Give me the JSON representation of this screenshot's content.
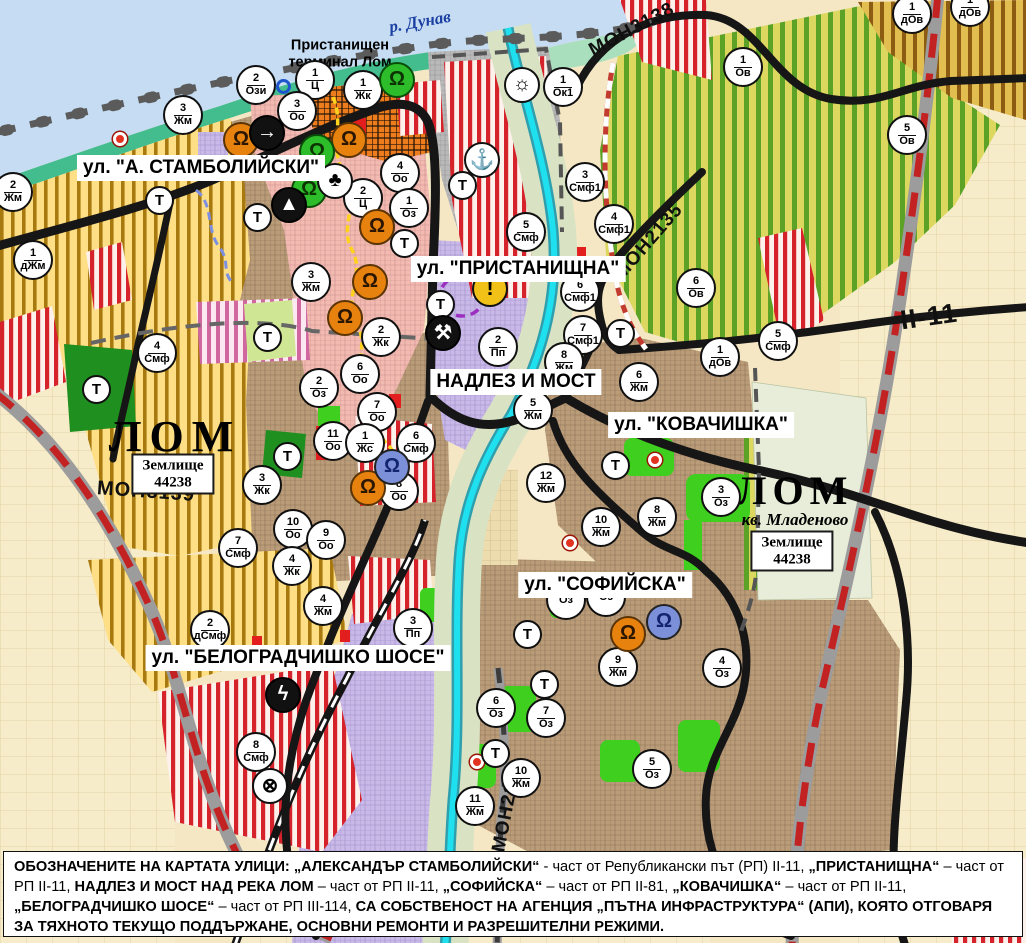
{
  "map": {
    "water_label": "р. Дунав",
    "port_terminal_label": "Пристанищен\nтерминал Лом",
    "t_label": "Т",
    "street_labels": [
      {
        "text": "ул. \"А. СТАМБОЛИЙСКИ\"",
        "x": 201,
        "y": 168
      },
      {
        "text": "ул. \"ПРИСТАНИЩНА\"",
        "x": 518,
        "y": 269
      },
      {
        "text": "НАДЛЕЗ И МОСТ",
        "x": 516,
        "y": 382
      },
      {
        "text": "ул. \"КОВАЧИШКА\"",
        "x": 701,
        "y": 425
      },
      {
        "text": "ул. \"СОФИЙСКА\"",
        "x": 605,
        "y": 585
      },
      {
        "text": "ул. \"БЕЛОГРАДЧИШКО ШОСЕ\"",
        "x": 298,
        "y": 658
      }
    ],
    "road_labels": [
      {
        "text": "МОН3138",
        "x": 632,
        "y": 30,
        "rot": -28,
        "size": 19
      },
      {
        "text": "МОН2135",
        "x": 649,
        "y": 242,
        "rot": -49,
        "size": 19
      },
      {
        "text": "МОН3139",
        "x": 146,
        "y": 492,
        "rot": 4,
        "size": 20
      },
      {
        "text": "МОН2136",
        "x": 508,
        "y": 806,
        "rot": -79,
        "size": 19
      },
      {
        "text": "II-11",
        "x": 929,
        "y": 317,
        "rot": -8,
        "size": 27
      }
    ],
    "place_labels": [
      {
        "text": "ЛОМ",
        "x": 175,
        "y": 437,
        "size": 44,
        "ls": 8,
        "sub": ""
      },
      {
        "text": "ЛОМ",
        "x": 795,
        "y": 500,
        "size": 40,
        "ls": 6,
        "sub": "кв. Младеново"
      }
    ],
    "land_boxes": [
      {
        "line1": "Землище",
        "line2": "44238",
        "x": 173,
        "y": 474
      },
      {
        "line1": "Землище",
        "line2": "44238",
        "x": 792,
        "y": 551
      }
    ],
    "zone_markers": [
      {
        "n": "2",
        "c": "Ози",
        "x": 256,
        "y": 85
      },
      {
        "n": "1",
        "c": "Ц",
        "x": 315,
        "y": 80
      },
      {
        "n": "1",
        "c": "Жк",
        "x": 363,
        "y": 90
      },
      {
        "n": "3",
        "c": "Оо",
        "x": 297,
        "y": 111
      },
      {
        "n": "3",
        "c": "Жм",
        "x": 183,
        "y": 115
      },
      {
        "n": "2",
        "c": "Жм",
        "x": 13,
        "y": 192
      },
      {
        "n": "1",
        "c": "дЖм",
        "x": 33,
        "y": 260
      },
      {
        "n": "4",
        "c": "Оо",
        "x": 400,
        "y": 173
      },
      {
        "n": "2",
        "c": "Ц",
        "x": 363,
        "y": 198
      },
      {
        "n": "1",
        "c": "Оз",
        "x": 409,
        "y": 208
      },
      {
        "n": "3",
        "c": "Жм",
        "x": 311,
        "y": 282
      },
      {
        "n": "2",
        "c": "Жк",
        "x": 381,
        "y": 337
      },
      {
        "n": "2",
        "c": "Оз",
        "x": 319,
        "y": 388
      },
      {
        "n": "6",
        "c": "Оо",
        "x": 360,
        "y": 374
      },
      {
        "n": "7",
        "c": "Оо",
        "x": 377,
        "y": 412
      },
      {
        "n": "11",
        "c": "Оо",
        "x": 333,
        "y": 441
      },
      {
        "n": "1",
        "c": "Жс",
        "x": 365,
        "y": 443
      },
      {
        "n": "6",
        "c": "Смф",
        "x": 416,
        "y": 443
      },
      {
        "n": "8",
        "c": "Оо",
        "x": 399,
        "y": 491
      },
      {
        "n": "10",
        "c": "Оо",
        "x": 293,
        "y": 529
      },
      {
        "n": "9",
        "c": "Оо",
        "x": 326,
        "y": 540
      },
      {
        "n": "7",
        "c": "Смф",
        "x": 238,
        "y": 548
      },
      {
        "n": "4",
        "c": "Жк",
        "x": 292,
        "y": 566
      },
      {
        "n": "3",
        "c": "Жк",
        "x": 262,
        "y": 485
      },
      {
        "n": "4",
        "c": "Смф",
        "x": 157,
        "y": 353
      },
      {
        "n": "4",
        "c": "Жм",
        "x": 323,
        "y": 606
      },
      {
        "n": "2",
        "c": "дСмф",
        "x": 210,
        "y": 630
      },
      {
        "n": "3",
        "c": "Пп",
        "x": 413,
        "y": 628
      },
      {
        "n": "8",
        "c": "Смф",
        "x": 256,
        "y": 752
      },
      {
        "n": "3",
        "c": "Смф1",
        "x": 585,
        "y": 182
      },
      {
        "n": "4",
        "c": "Смф1",
        "x": 614,
        "y": 224
      },
      {
        "n": "5",
        "c": "Смф",
        "x": 526,
        "y": 232
      },
      {
        "n": "1",
        "c": "Ок1",
        "x": 563,
        "y": 87
      },
      {
        "n": "6",
        "c": "Смф1",
        "x": 580,
        "y": 292
      },
      {
        "n": "7",
        "c": "Смф1",
        "x": 583,
        "y": 335
      },
      {
        "n": "2",
        "c": "Пп",
        "x": 498,
        "y": 347
      },
      {
        "n": "5",
        "c": "Жм",
        "x": 533,
        "y": 410
      },
      {
        "n": "8",
        "c": "Жм",
        "x": 564,
        "y": 362
      },
      {
        "n": "6",
        "c": "Жм",
        "x": 639,
        "y": 382
      },
      {
        "n": "12",
        "c": "Жм",
        "x": 546,
        "y": 483
      },
      {
        "n": "10",
        "c": "Жм",
        "x": 601,
        "y": 527
      },
      {
        "n": "8",
        "c": "Жм",
        "x": 657,
        "y": 517
      },
      {
        "n": "3",
        "c": "Оз",
        "x": 721,
        "y": 497
      },
      {
        "n": "1",
        "c": "Ов",
        "x": 743,
        "y": 67
      },
      {
        "n": "5",
        "c": "Ов",
        "x": 907,
        "y": 135
      },
      {
        "n": "1",
        "c": "дОв",
        "x": 912,
        "y": 14
      },
      {
        "n": "1",
        "c": "дОв",
        "x": 970,
        "y": 7
      },
      {
        "n": "6",
        "c": "Ов",
        "x": 696,
        "y": 288
      },
      {
        "n": "1",
        "c": "дОв",
        "x": 720,
        "y": 357
      },
      {
        "n": "5",
        "c": "Смф",
        "x": 778,
        "y": 341
      },
      {
        "n": "",
        "c": "Оз",
        "x": 566,
        "y": 600
      },
      {
        "n": "",
        "c": "Оз",
        "x": 606,
        "y": 597
      },
      {
        "n": "9",
        "c": "Жм",
        "x": 618,
        "y": 667
      },
      {
        "n": "4",
        "c": "Оз",
        "x": 722,
        "y": 668
      },
      {
        "n": "6",
        "c": "Оз",
        "x": 496,
        "y": 708
      },
      {
        "n": "7",
        "c": "Оз",
        "x": 546,
        "y": 718
      },
      {
        "n": "5",
        "c": "Оз",
        "x": 652,
        "y": 769
      },
      {
        "n": "10",
        "c": "Жм",
        "x": 521,
        "y": 778
      },
      {
        "n": "11",
        "c": "Жм",
        "x": 475,
        "y": 806
      }
    ],
    "t_markers": [
      {
        "x": 160,
        "y": 201
      },
      {
        "x": 258,
        "y": 218
      },
      {
        "x": 463,
        "y": 186
      },
      {
        "x": 405,
        "y": 244
      },
      {
        "x": 441,
        "y": 305
      },
      {
        "x": 621,
        "y": 334
      },
      {
        "x": 268,
        "y": 338
      },
      {
        "x": 97,
        "y": 390
      },
      {
        "x": 288,
        "y": 457
      },
      {
        "x": 616,
        "y": 466
      },
      {
        "x": 528,
        "y": 635
      },
      {
        "x": 545,
        "y": 685
      },
      {
        "x": 496,
        "y": 754
      }
    ],
    "icon_defs": {
      "monument": {
        "glyph": "Ω"
      },
      "sun": {
        "glyph": "☼"
      },
      "anchor": {
        "glyph": "⚓"
      },
      "club": {
        "glyph": "♣"
      },
      "mountain": {
        "glyph": "▲"
      },
      "arrow": {
        "glyph": "→"
      },
      "truck": {
        "glyph": "⚒"
      },
      "warning": {
        "glyph": "!"
      },
      "lightning": {
        "glyph": "ϟ"
      },
      "rail": {
        "glyph": "⊗"
      }
    },
    "icon_markers": [
      {
        "t": "monument",
        "v": "orange",
        "x": 241,
        "y": 140
      },
      {
        "t": "monument",
        "v": "orange",
        "x": 349,
        "y": 140
      },
      {
        "t": "monument",
        "v": "orange",
        "x": 377,
        "y": 227
      },
      {
        "t": "monument",
        "v": "orange",
        "x": 370,
        "y": 282
      },
      {
        "t": "monument",
        "v": "orange",
        "x": 345,
        "y": 318
      },
      {
        "t": "monument",
        "v": "orange",
        "x": 368,
        "y": 488
      },
      {
        "t": "monument",
        "v": "orange",
        "x": 628,
        "y": 634
      },
      {
        "t": "monument",
        "v": "green",
        "x": 397,
        "y": 80
      },
      {
        "t": "monument",
        "v": "green",
        "x": 317,
        "y": 152
      },
      {
        "t": "monument",
        "v": "green",
        "x": 309,
        "y": 190
      },
      {
        "t": "monument",
        "v": "blue",
        "x": 392,
        "y": 467
      },
      {
        "t": "monument",
        "v": "blue",
        "x": 664,
        "y": 622
      },
      {
        "t": "sun",
        "v": "white",
        "x": 522,
        "y": 85
      },
      {
        "t": "anchor",
        "v": "white",
        "x": 482,
        "y": 160
      },
      {
        "t": "club",
        "v": "white",
        "x": 335,
        "y": 181
      },
      {
        "t": "mountain",
        "v": "black",
        "x": 289,
        "y": 205
      },
      {
        "t": "arrow",
        "v": "black",
        "x": 267,
        "y": 133
      },
      {
        "t": "truck",
        "v": "black",
        "x": 443,
        "y": 333
      },
      {
        "t": "warning",
        "v": "warning",
        "x": 490,
        "y": 289
      },
      {
        "t": "lightning",
        "v": "black",
        "x": 283,
        "y": 695
      },
      {
        "t": "rail",
        "v": "white",
        "x": 270,
        "y": 786
      }
    ],
    "dots": [
      {
        "k": "blue",
        "x": 284,
        "y": 87
      },
      {
        "k": "red",
        "x": 120,
        "y": 139
      },
      {
        "k": "red",
        "x": 655,
        "y": 460
      },
      {
        "k": "red",
        "x": 570,
        "y": 543
      },
      {
        "k": "red",
        "x": 477,
        "y": 762
      }
    ],
    "colors": {
      "water": "#c5dcf2",
      "coast": "#43bd8d",
      "urban_brown": "#ba9c79",
      "smf_red_stripe": "#d6232b",
      "agri_yellow": "#ffdf85",
      "vineyard_green": "#5ba226",
      "industry_lavender": "#c9b9e8",
      "port_grey": "#b9b9b9",
      "center_pink": "#f3bab2",
      "terminal_orange": "#ec7c1c",
      "river_cyan": "#1fe0ee",
      "park_green": "#3fcf1f",
      "rp_road_red": "#c22222",
      "road_black": "#161616"
    }
  },
  "footer": {
    "segments": [
      {
        "t": "ОБОЗНАЧЕНИТЕ НА КАРТАТА УЛИЦИ: „АЛЕКСАНДЪР СТАМБОЛИЙСКИ“",
        "b": 1
      },
      {
        "t": " - част от Републикански път (РП) II-11, ",
        "b": 0
      },
      {
        "t": "„ПРИСТАНИЩНА“",
        "b": 1
      },
      {
        "t": " – част от РП II-11, ",
        "b": 0
      },
      {
        "t": "НАДЛЕЗ И МОСТ НАД РЕКА ЛОМ",
        "b": 1
      },
      {
        "t": " – част от РП II-11, ",
        "b": 0
      },
      {
        "t": "„СОФИЙСКА“",
        "b": 1
      },
      {
        "t": " – част от РП II-81, ",
        "b": 0
      },
      {
        "t": "„КОВАЧИШКА“",
        "b": 1
      },
      {
        "t": " – част от РП II-11, ",
        "b": 0
      },
      {
        "t": "„БЕЛОГРАДЧИШКО ШОСЕ“",
        "b": 1
      },
      {
        "t": " – част от РП III-114, ",
        "b": 0
      },
      {
        "t": "СА СОБСТВЕНОСТ НА АГЕНЦИЯ „ПЪТНА ИНФРАСТРУКТУРА“ (АПИ), КОЯТО ОТГОВАРЯ ЗА ТЯХНОТО ТЕКУЩО ПОДДЪРЖАНЕ, ОСНОВНИ РЕМОНТИ И РАЗРЕШИТЕЛНИ РЕЖИМИ.",
        "b": 1
      }
    ]
  }
}
